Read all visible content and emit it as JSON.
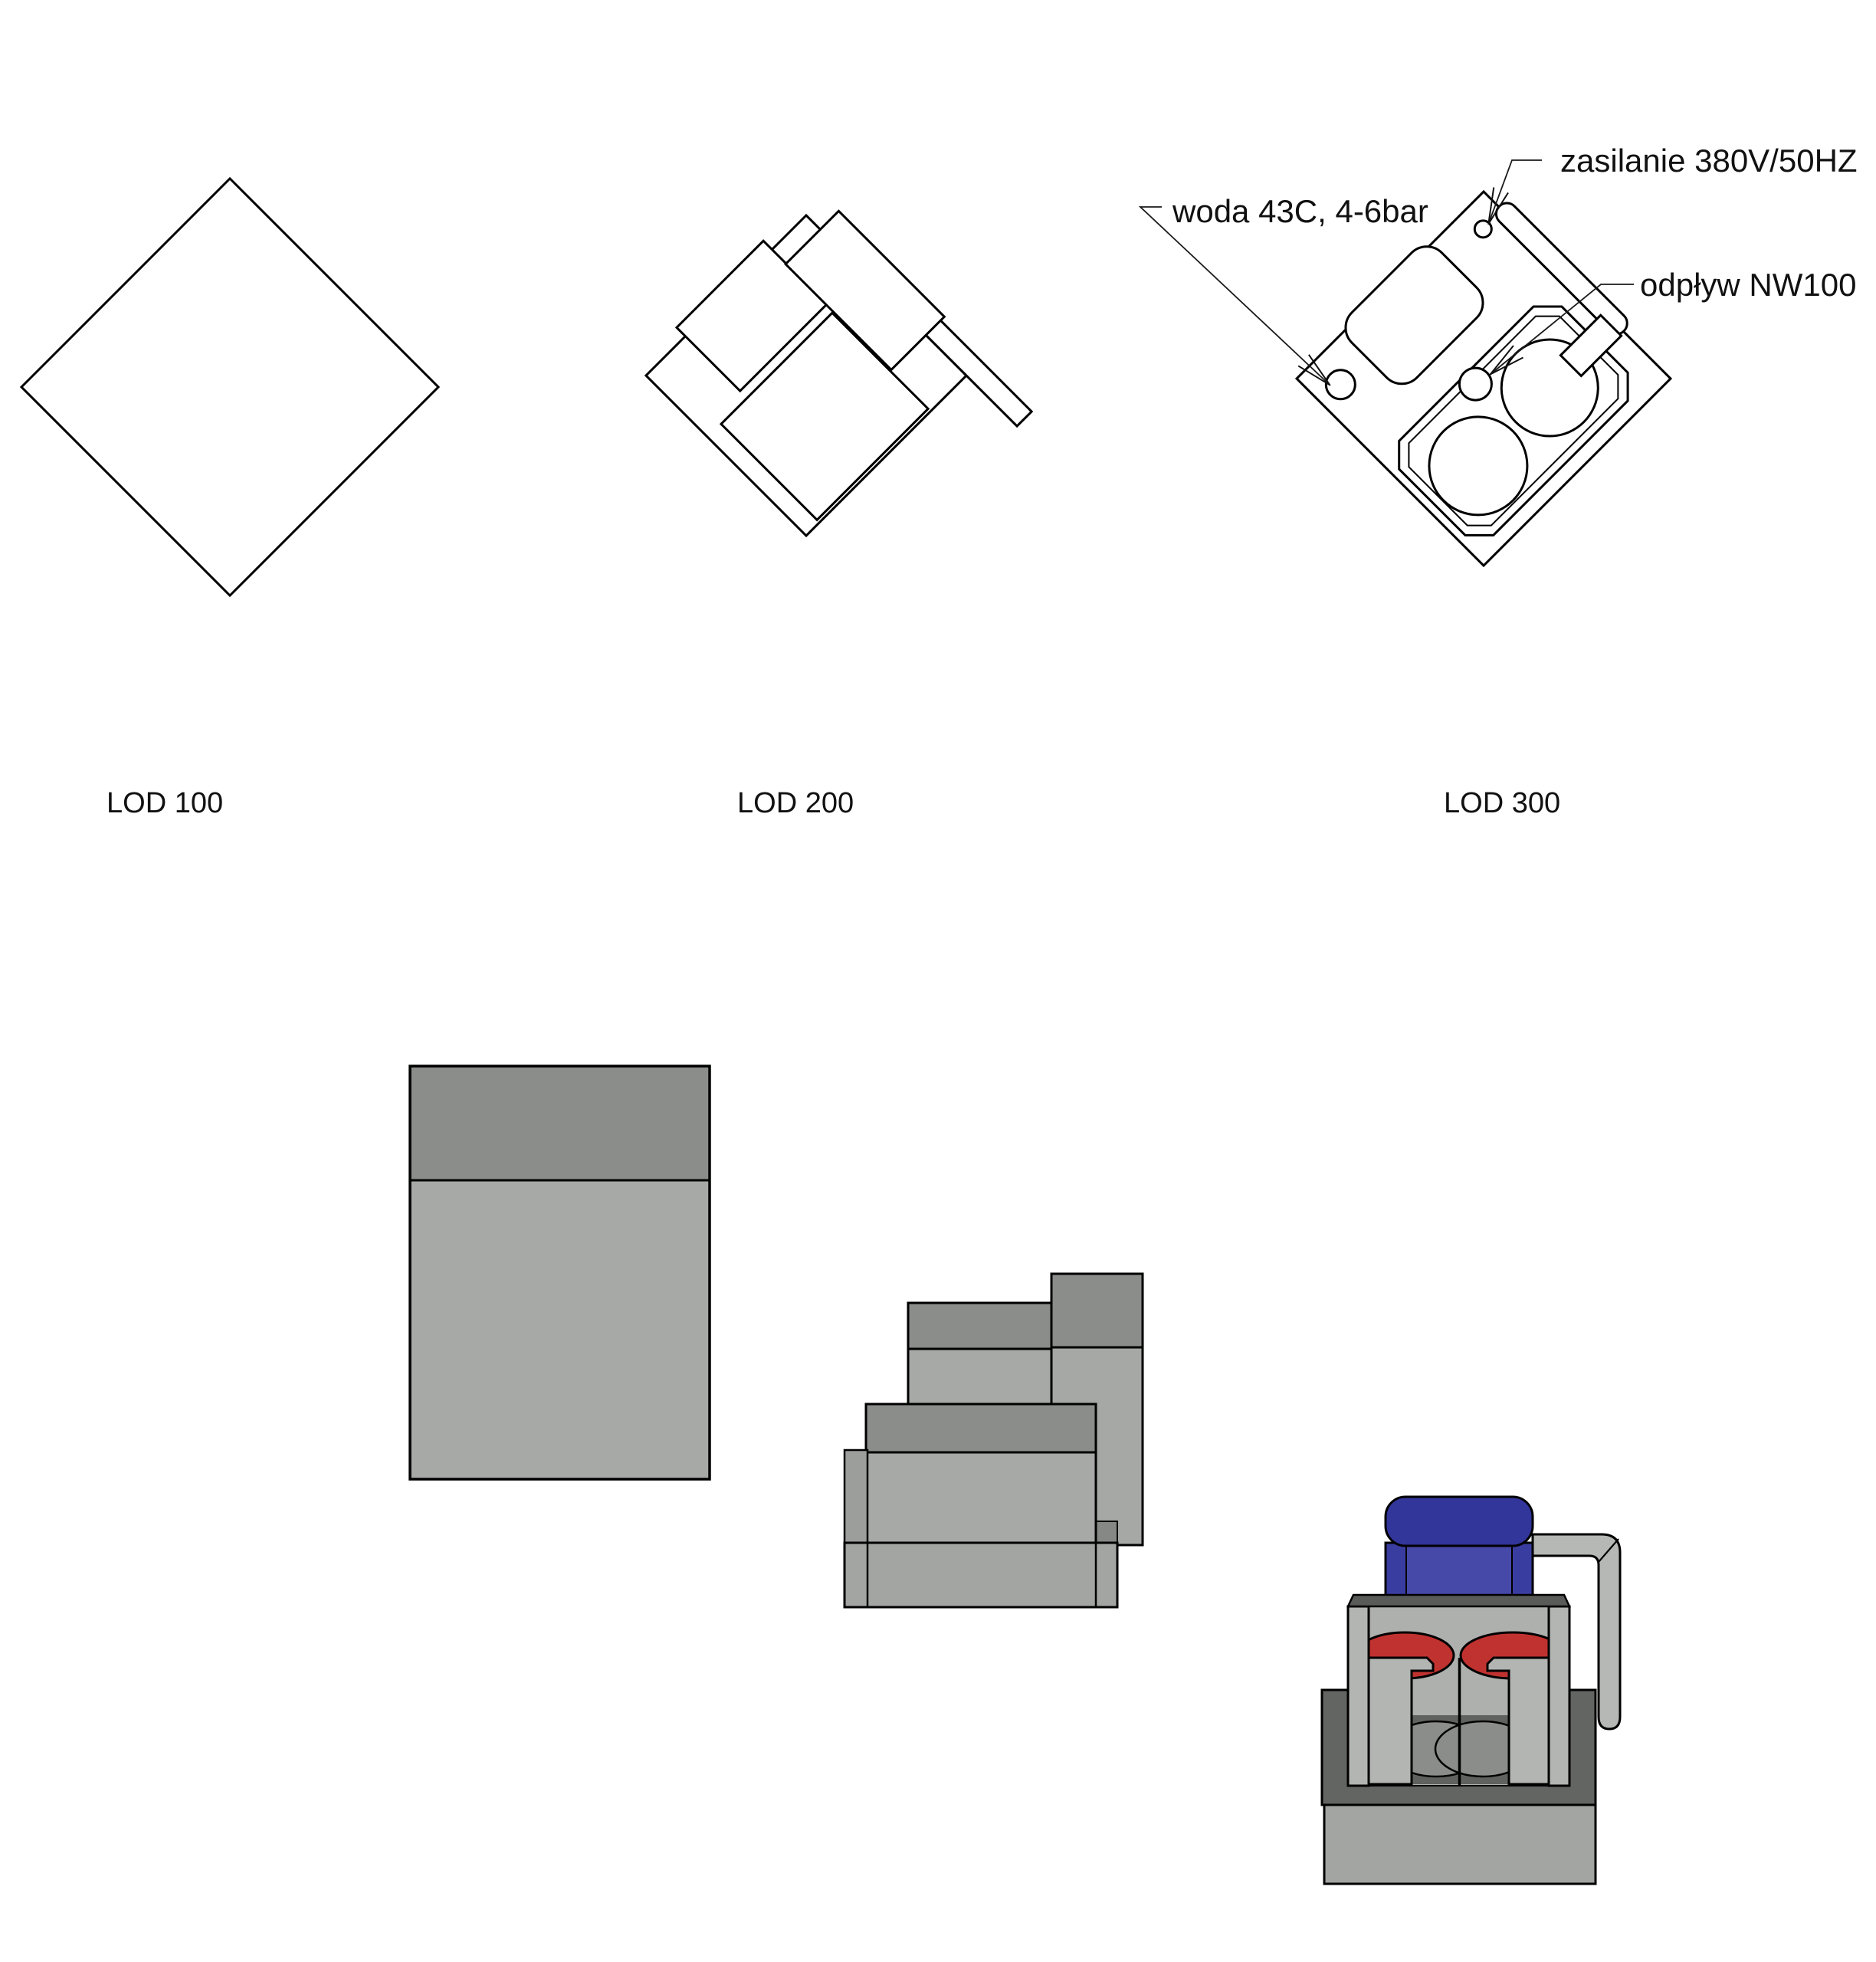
{
  "figures": {
    "lod100": {
      "label": "LOD 100"
    },
    "lod200": {
      "label": "LOD 200"
    },
    "lod300": {
      "label": "LOD 300",
      "annotations": {
        "water": "woda 43C, 4-6bar",
        "power": "zasilanie 380V/50HZ",
        "drain": "odpływ NW100"
      }
    }
  },
  "colors": {
    "background": "#ffffff",
    "line": "#000000",
    "box_top": "#8a8d8a",
    "box_body": "#a6a9a6",
    "box_body_alt": "#a5a8a5",
    "sliver_gray": "#9b9e9b",
    "dark_step": "#858884",
    "plinth": "#a2a5a2",
    "platform_dark": "#636562",
    "wall_gray": "#b3b5b2",
    "inner_gray": "#aeb0ad",
    "inner_dark": "#60625f",
    "cylinder_gray": "#8b8d8a",
    "rim_dark": "#595b58",
    "basin_red": "#c0322f",
    "hood_blue_top": "#32359a",
    "hood_blue": "#3a3da0",
    "hood_blue_panel": "#4649a8",
    "pipe_gray": "#b6b8b5"
  }
}
